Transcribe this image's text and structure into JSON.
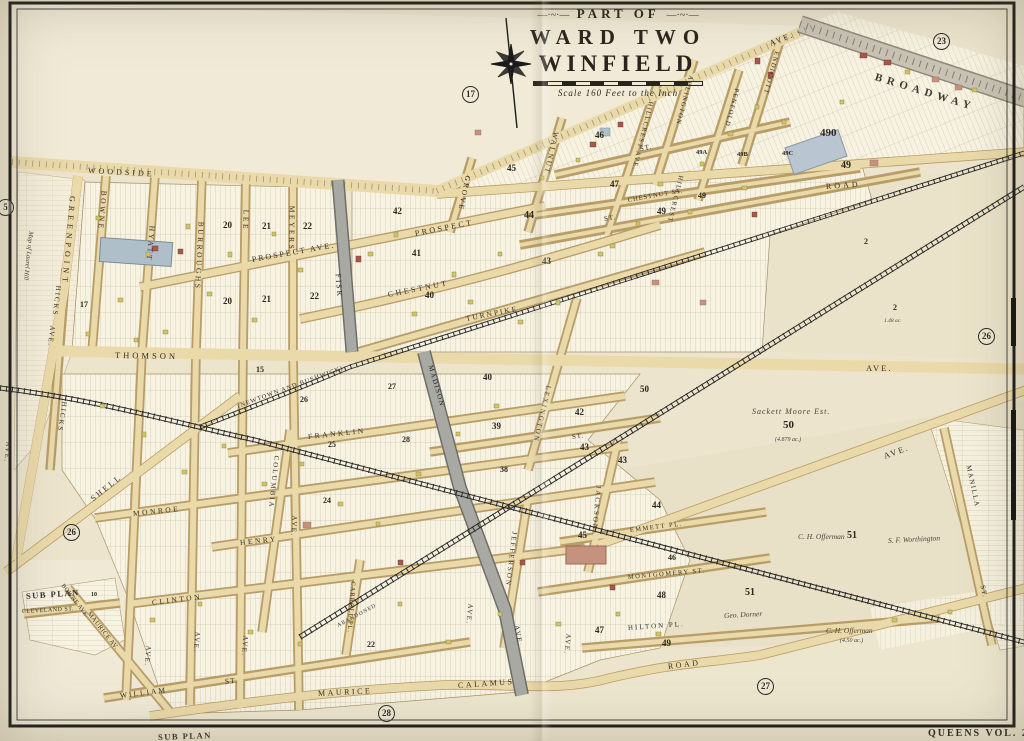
{
  "map": {
    "title_part_of": "PART OF",
    "title_ward": "WARD TWO",
    "title_name": "WINFIELD",
    "scale_text": "Scale 160 Feet to the Inch",
    "ornament_left": "—·~·—",
    "ornament_right": "—·~·—",
    "volume_label": "QUEENS VOL. 2"
  },
  "plate_circles": [
    "23",
    "17",
    "5",
    "26",
    "26",
    "27",
    "28"
  ],
  "streets": [
    "WOODSIDE",
    "AVE.",
    "BROADWAY",
    "ROAD",
    "GREENPOINT",
    "BOWNE",
    "HYATT",
    "BURROUGHS",
    "LEE",
    "MEYERS",
    "FISK",
    "GROVE",
    "WALNUT",
    "HILLCREST AVE.",
    "HILLCREST",
    "ARLINGTON",
    "PENFOLD",
    "ENDICOTT",
    "ST.",
    "CHESTNUT ST.",
    "ST.",
    "PROSPECT AVE.",
    "PROSPECT",
    "CHESTNUT",
    "TURNPIKE",
    "THOMSON",
    "AVE.",
    "(NEWTOWN AND BUSHWICK)",
    "HICKS",
    "AVE.",
    "HICKS",
    "MADISON",
    "LEXINGTON",
    "ST.",
    "FRANKLIN",
    "COLUMBIA",
    "SHELL",
    "MONROE",
    "HENRY",
    "AVE.",
    "CLINTON",
    "CLEVELAND ST.",
    "SUB PLAN",
    "BOWNE AVE.",
    "MAURICE AV.",
    "WILLIAM",
    "ST.",
    "MAURICE",
    "CALAMUS",
    "ROAD",
    "CARROLL PL.",
    "AVE.",
    "AVE.",
    "AVE.",
    "AVE.",
    "ABANDONED",
    "AVE.",
    "JEFFERSON",
    "JACKSON",
    "AVE.",
    "EMMETT PL.",
    "MONTGOMERY ST.",
    "HILTON PL.",
    "MANILLA",
    "ST.",
    "SUB PLAN",
    "AVE.",
    "AVE."
  ],
  "blocks": [
    "490",
    "49",
    "49A",
    "49B",
    "49C",
    "46",
    "45",
    "47",
    "49",
    "49",
    "44",
    "42",
    "41",
    "40",
    "43",
    "22",
    "21",
    "20",
    "22",
    "21",
    "20",
    "17",
    "15",
    "26",
    "25",
    "24",
    "27",
    "28",
    "40",
    "39",
    "38",
    "42",
    "43",
    "43",
    "44",
    "45",
    "46",
    "48",
    "49",
    "47",
    "22",
    "50",
    "50",
    "51",
    "51",
    "2",
    "2",
    "10"
  ],
  "names": [
    "Sackett Moore Est.",
    "(4.879 ac.)",
    "C. H. Offerman",
    "C. H. Offerman",
    "(4.50 ac.)",
    "S. F. Worthington",
    "Geo. Dorner",
    "Map of Laurel Hill",
    "1.48 ac."
  ],
  "colors": {
    "parchment": "#ece4cc",
    "road_tan": "#ead9a9",
    "rail_black": "#2a2a2a",
    "paved_gray": "#a9a9a4",
    "broadway_gray": "#c9c3b4",
    "building_yellow": "#cfc468",
    "building_pink": "#c4927f",
    "building_red": "#a8574a"
  }
}
